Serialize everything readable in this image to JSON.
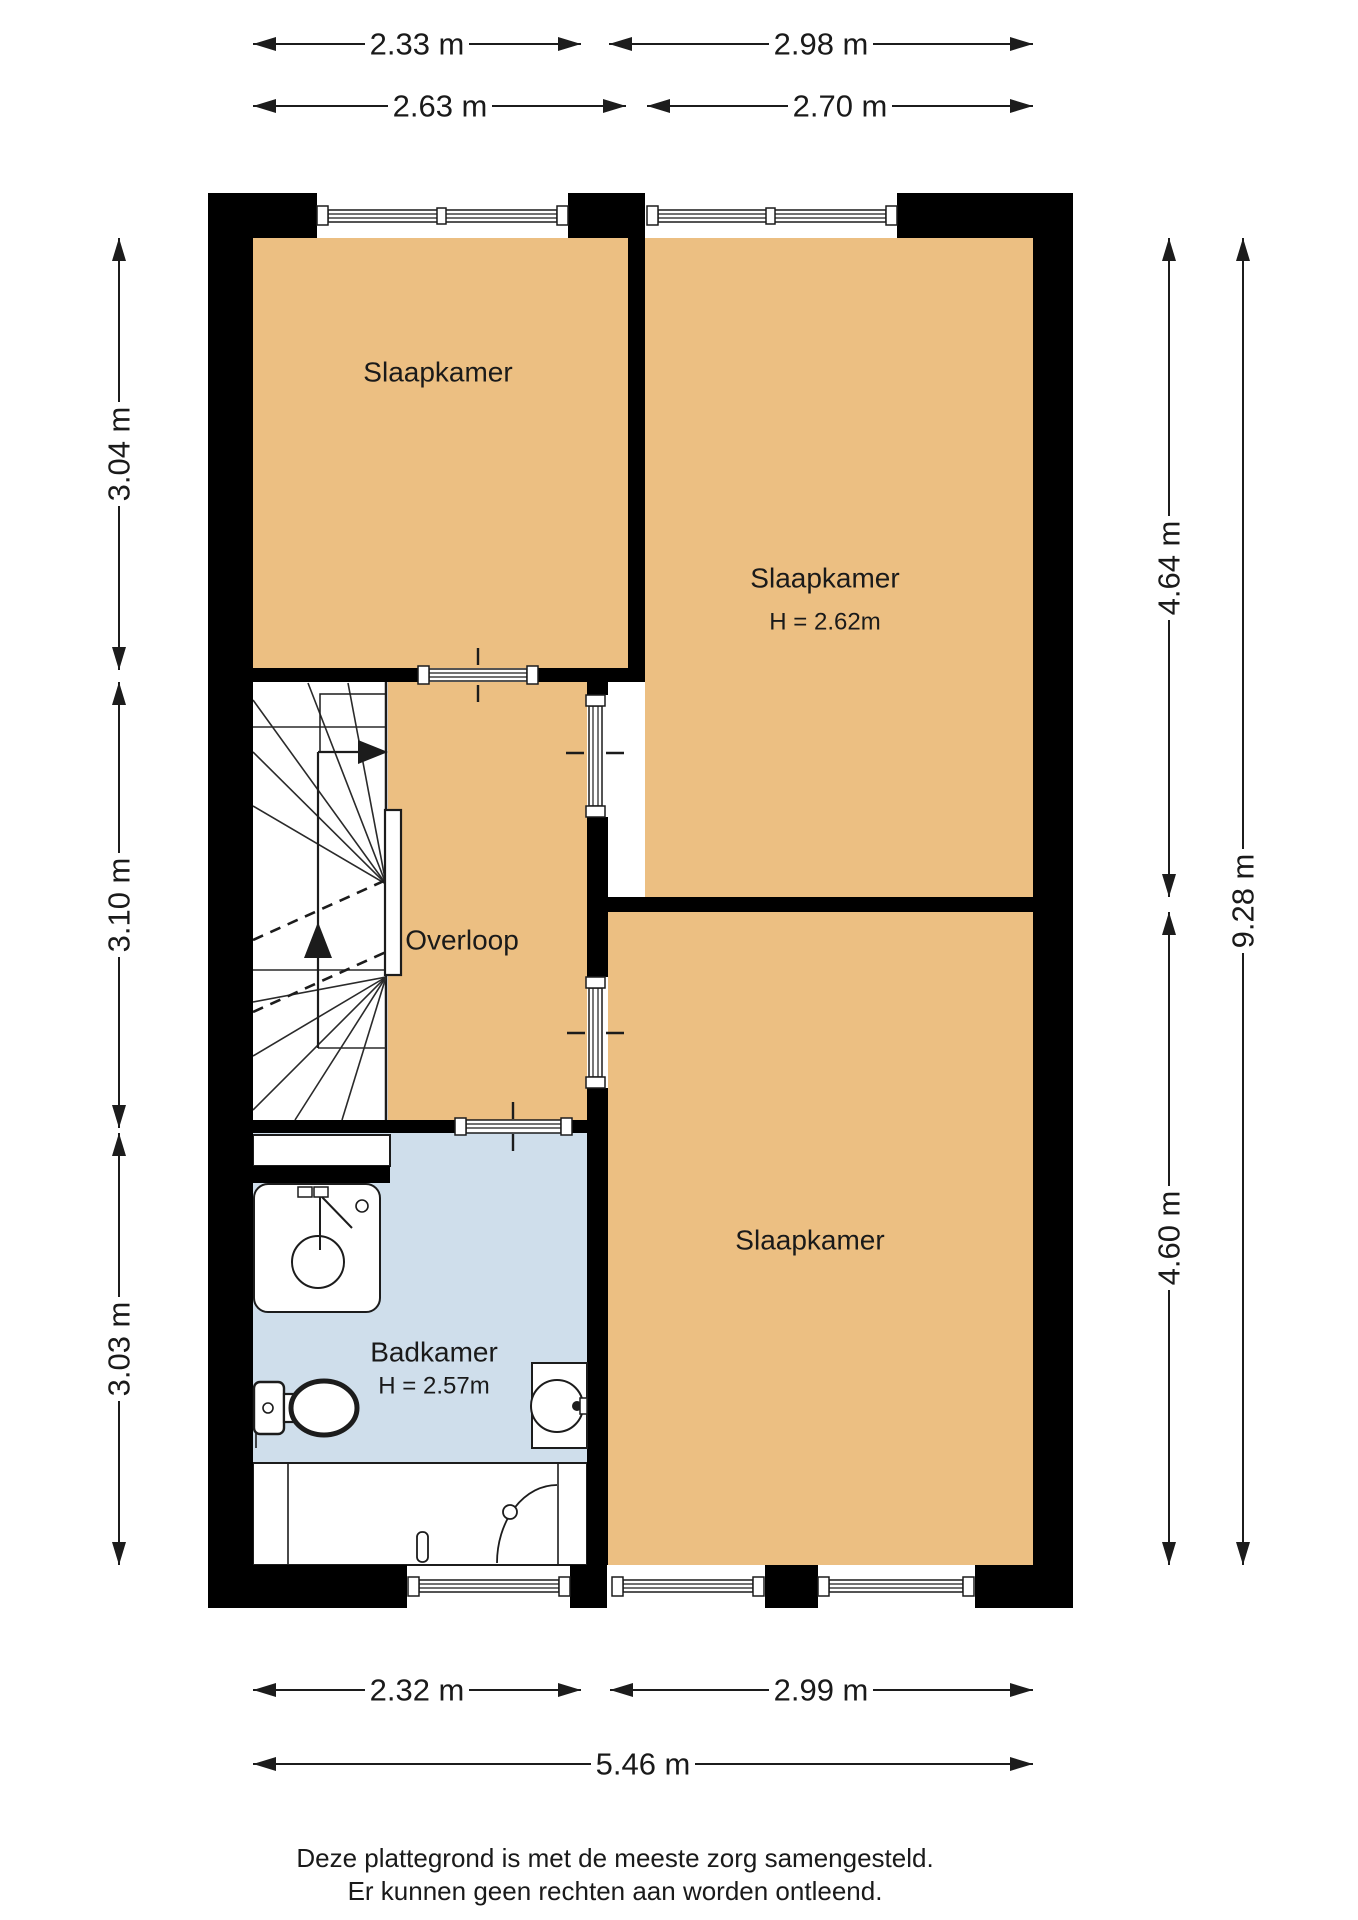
{
  "plan": {
    "rooms": {
      "bedroom_top_left": {
        "label": "Slaapkamer"
      },
      "bedroom_top_right": {
        "label": "Slaapkamer",
        "ceiling_height": "H = 2.62m"
      },
      "bedroom_bottom_right": {
        "label": "Slaapkamer"
      },
      "landing": {
        "label": "Overloop"
      },
      "bathroom": {
        "label": "Badkamer",
        "ceiling_height": "H = 2.57m"
      }
    },
    "dimensions": {
      "top_row1_left": "2.33 m",
      "top_row1_right": "2.98 m",
      "top_row2_left": "2.63 m",
      "top_row2_right": "2.70 m",
      "left_top": "3.04 m",
      "left_middle": "3.10 m",
      "left_bottom": "3.03 m",
      "right_top": "4.64 m",
      "right_bottom": "4.60 m",
      "right_total": "9.28 m",
      "bottom_left": "2.32 m",
      "bottom_right": "2.99 m",
      "bottom_total": "5.46 m"
    },
    "colors": {
      "wall": "#000000",
      "floor": "#ecbf82",
      "bathroom_floor": "#cfdeeb",
      "line": "#1c1c1c"
    }
  },
  "footer": {
    "line1": "Deze plattegrond is met de meeste zorg samengesteld.",
    "line2": "Er kunnen geen rechten aan worden ontleend."
  }
}
